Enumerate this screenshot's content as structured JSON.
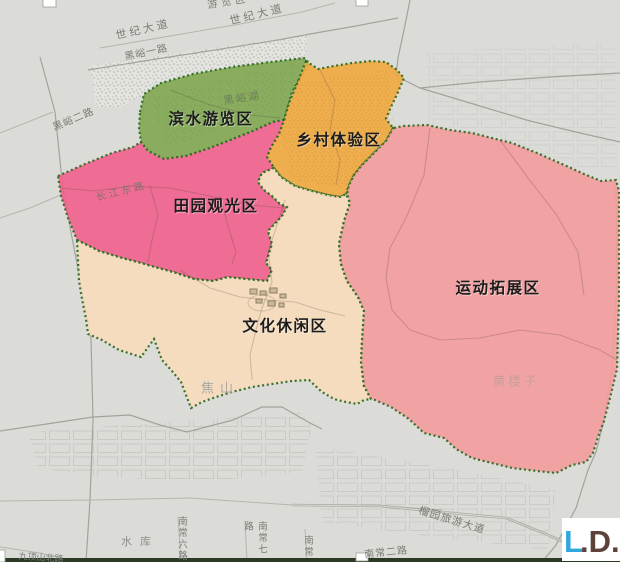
{
  "zones": [
    {
      "name": "滨水游览区",
      "color": "#7fa651"
    },
    {
      "name": "乡村体验区",
      "color": "#efa93f"
    },
    {
      "name": "田园观光区",
      "color": "#f1618d"
    },
    {
      "name": "文化休闲区",
      "color": "#f7dcbc"
    },
    {
      "name": "运动拓展区",
      "color": "#f29c9c"
    }
  ],
  "boundary_color": "#2d6b22",
  "roads": {
    "century_ave_1": "世纪大道",
    "century_ave_2": "世纪大道",
    "heiyu_road_1": "黑峪一路",
    "heiyu_road_2": "黑峪二路",
    "changjiang_east_road": "长江东路",
    "liuyuan_tourism_ave": "榴园旅游大道",
    "nanchang_road_2": "南常二路",
    "nanchang_road_6": "南常六路",
    "nanchang_road_7": "南常七路",
    "nanchang_partial": "南常",
    "jiudingshan_north_road": "九顶山北路"
  },
  "places": {
    "heiyu_lake": "黑峪湖",
    "jiaoshan": "焦山",
    "huanglouzi": "黄楼子",
    "reservoir": "水库",
    "top_edge_partial": "游览区"
  },
  "logo": {
    "l": "L",
    "d": ".D.",
    "l_color": "#31a8dc",
    "d_color": "#5c4238"
  }
}
